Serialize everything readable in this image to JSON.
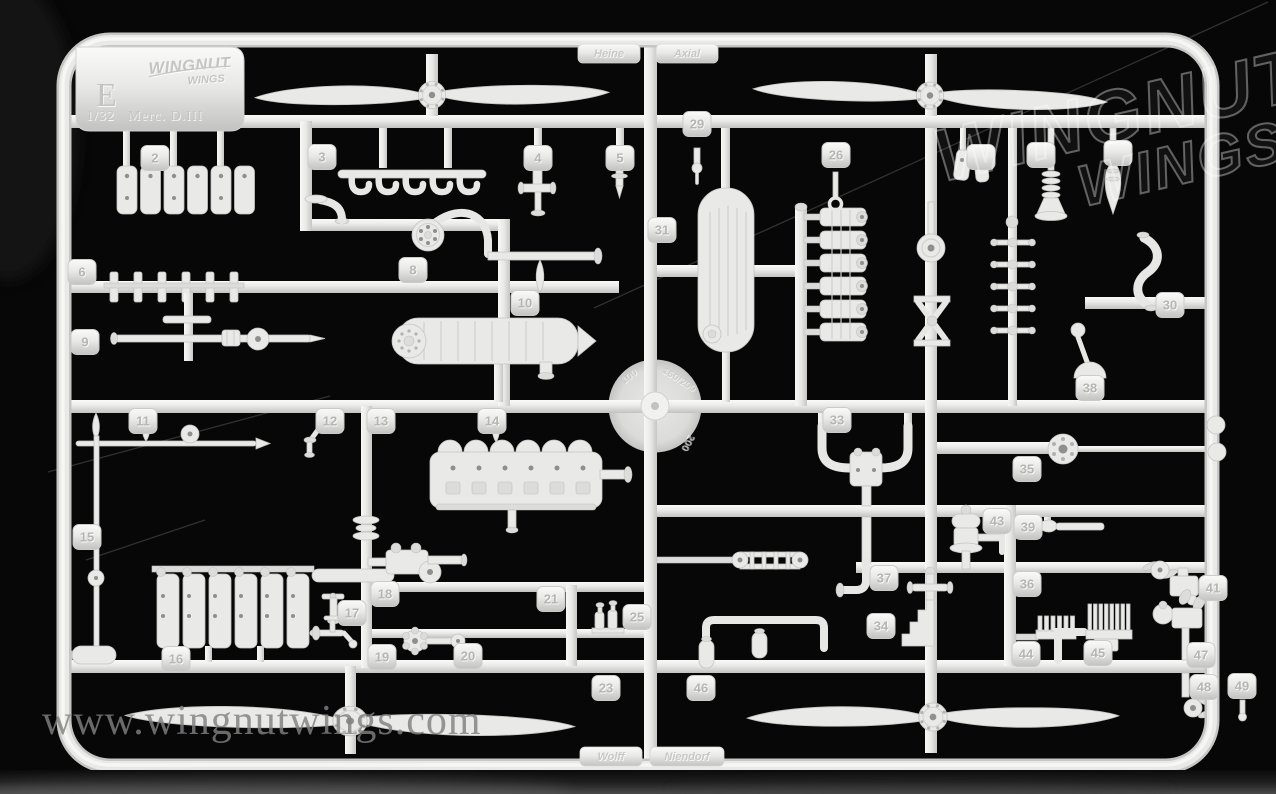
{
  "palette": {
    "plastic": "#e9e9e7",
    "background": "#060606",
    "watermark_gray": "#808080"
  },
  "label_tab": {
    "sprue_letter": "E",
    "brand_line1": "WINGNUT",
    "brand_line2": "WINGS",
    "scale_text": "1/32",
    "subject_text": "Merc. D.III"
  },
  "molded_plates": {
    "top_left": "Heine",
    "top_right": "Axial",
    "bottom_left": "Wolff",
    "bottom_right": "Niendorf"
  },
  "center_disc": {
    "markings": [
      "100",
      "160/200",
      "200"
    ]
  },
  "watermarks": {
    "url": "www.wingnutwings.com",
    "logo_line1": "WINGNUT",
    "logo_line2": "WINGS"
  },
  "part_tags": [
    {
      "n": "2",
      "x": 155,
      "y": 158
    },
    {
      "n": "3",
      "x": 322,
      "y": 157
    },
    {
      "n": "4",
      "x": 538,
      "y": 158
    },
    {
      "n": "5",
      "x": 620,
      "y": 158
    },
    {
      "n": "29",
      "x": 697,
      "y": 124
    },
    {
      "n": "26",
      "x": 836,
      "y": 155
    },
    {
      "n": "",
      "x": 981,
      "y": 157
    },
    {
      "n": "",
      "x": 1041,
      "y": 155
    },
    {
      "n": "",
      "x": 1118,
      "y": 153
    },
    {
      "n": "31",
      "x": 662,
      "y": 230
    },
    {
      "n": "6",
      "x": 82,
      "y": 272
    },
    {
      "n": "8",
      "x": 413,
      "y": 270
    },
    {
      "n": "10",
      "x": 525,
      "y": 303
    },
    {
      "n": "30",
      "x": 1170,
      "y": 305
    },
    {
      "n": "9",
      "x": 85,
      "y": 342
    },
    {
      "n": "38",
      "x": 1090,
      "y": 388
    },
    {
      "n": "11",
      "x": 143,
      "y": 421
    },
    {
      "n": "12",
      "x": 330,
      "y": 421
    },
    {
      "n": "13",
      "x": 381,
      "y": 421
    },
    {
      "n": "14",
      "x": 492,
      "y": 421
    },
    {
      "n": "33",
      "x": 837,
      "y": 420
    },
    {
      "n": "35",
      "x": 1027,
      "y": 469
    },
    {
      "n": "43",
      "x": 997,
      "y": 521
    },
    {
      "n": "39",
      "x": 1028,
      "y": 527
    },
    {
      "n": "15",
      "x": 87,
      "y": 537
    },
    {
      "n": "37",
      "x": 884,
      "y": 578
    },
    {
      "n": "36",
      "x": 1027,
      "y": 584
    },
    {
      "n": "18",
      "x": 385,
      "y": 594
    },
    {
      "n": "21",
      "x": 551,
      "y": 599
    },
    {
      "n": "41",
      "x": 1213,
      "y": 588
    },
    {
      "n": "17",
      "x": 352,
      "y": 613
    },
    {
      "n": "25",
      "x": 637,
      "y": 617
    },
    {
      "n": "34",
      "x": 881,
      "y": 626
    },
    {
      "n": "16",
      "x": 176,
      "y": 659
    },
    {
      "n": "19",
      "x": 382,
      "y": 657
    },
    {
      "n": "20",
      "x": 468,
      "y": 656
    },
    {
      "n": "44",
      "x": 1026,
      "y": 654
    },
    {
      "n": "45",
      "x": 1098,
      "y": 653
    },
    {
      "n": "47",
      "x": 1201,
      "y": 655
    },
    {
      "n": "23",
      "x": 606,
      "y": 688
    },
    {
      "n": "46",
      "x": 701,
      "y": 688
    },
    {
      "n": "48",
      "x": 1204,
      "y": 687
    },
    {
      "n": "49",
      "x": 1242,
      "y": 686
    }
  ]
}
